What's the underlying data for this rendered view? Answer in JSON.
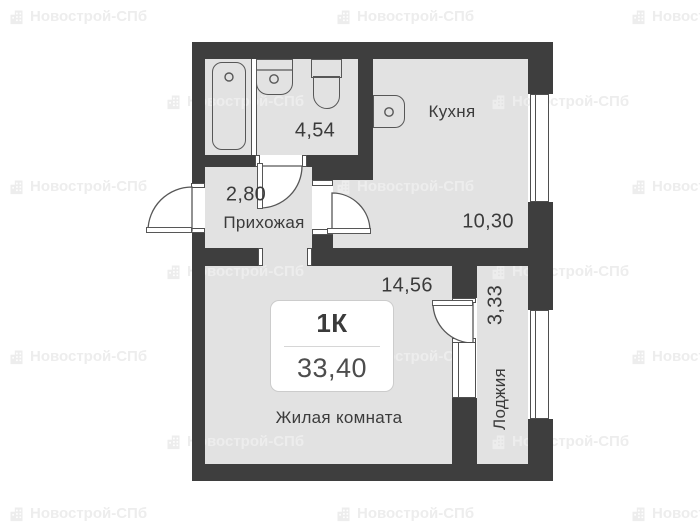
{
  "watermark": {
    "text": "Новострой-СПб"
  },
  "plan": {
    "card": {
      "type": "1К",
      "total_area": "33,40"
    },
    "rooms": {
      "bathroom": {
        "area": "4,54"
      },
      "kitchen": {
        "name": "Кухня",
        "area": "10,30"
      },
      "hallway": {
        "name": "Прихожая",
        "area": "2,80"
      },
      "living": {
        "name": "Жилая комната",
        "area": "14,56"
      },
      "loggia": {
        "name": "Лоджия",
        "area": "3,33"
      }
    },
    "colors": {
      "wall": "#3e3e3e",
      "floor": "#e2e2e2",
      "text": "#3b3b3b",
      "watermark": "#ededed"
    }
  }
}
